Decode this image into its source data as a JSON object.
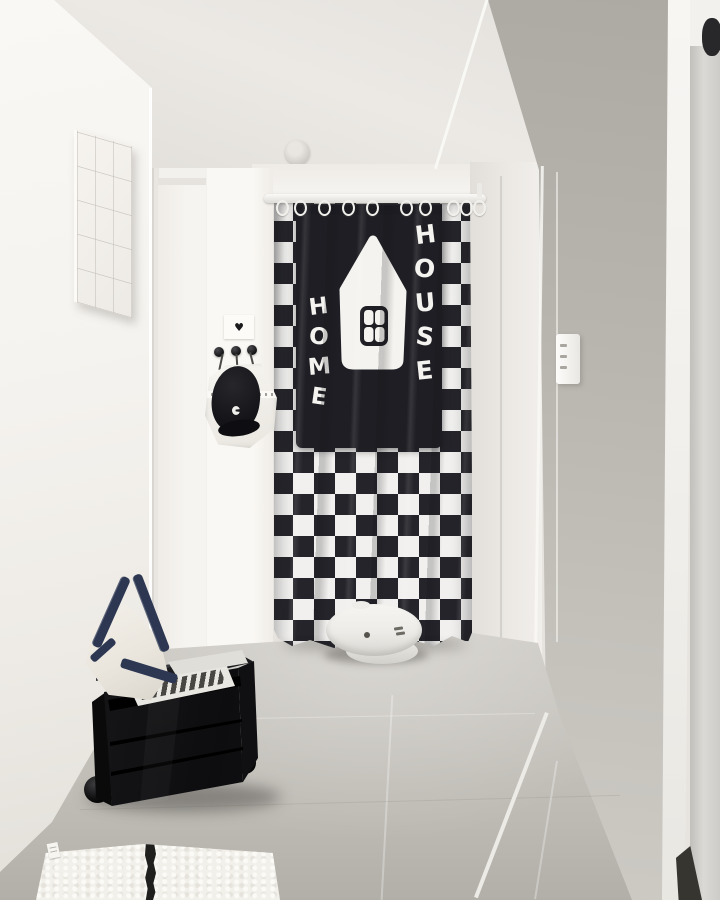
{
  "scene": {
    "setting": "apartment hallway entryway photo",
    "curtain": {
      "word_left": "HOME",
      "word_right": "HOUSE",
      "pattern": "black-white checkerboard noren",
      "black": "#232329",
      "white": "#f1f0ee"
    },
    "heart_card": {
      "glyph": "♥"
    },
    "objects": {
      "robot_vacuum": "white robot vacuum",
      "utility_cart": "black rolling drawer cart with papers",
      "tote_bag": "white canvas tote with navy straps",
      "hanging_pouch": "sheer pouch holding black cap",
      "tile_art": "white relief tile panel",
      "rug": "white shag rug with black stripe",
      "light_switch": "three-button wall switch",
      "ceiling_sensor": "round ceiling detector"
    },
    "colors": {
      "wall_white": "#f6f4f1",
      "wall_gray": "#b5b2ab",
      "floor_gray": "#c6c3bd",
      "strap_navy": "#2d3752"
    }
  }
}
